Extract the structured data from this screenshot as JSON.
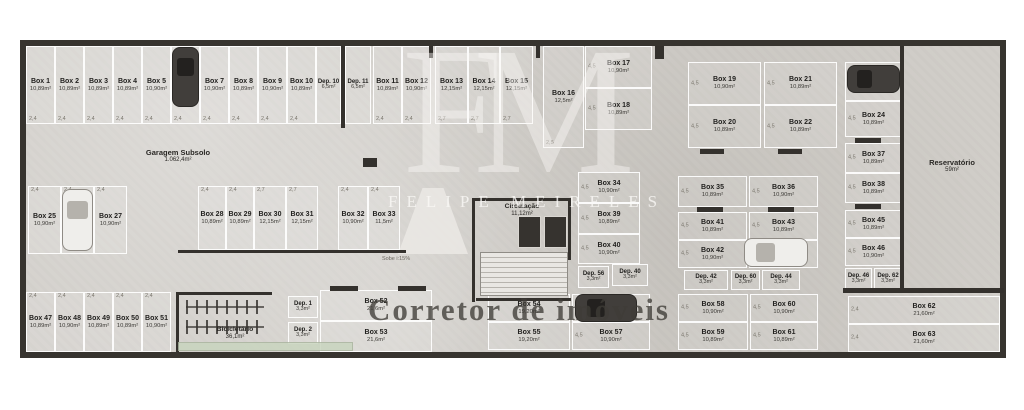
{
  "watermark": {
    "monogram": "FM",
    "name": "FELIPE MEIRELES",
    "tagline": "Corretor de imóveis"
  },
  "rooms": {
    "garage": {
      "label": "Garagem Subsolo",
      "area": "1.062,4m²"
    },
    "circulation": {
      "label": "Circulação",
      "area": "11,12m²"
    },
    "reservoir": {
      "label": "Reservatório",
      "area": "59m²"
    },
    "bike_room": {
      "label": "Bicicletário",
      "area": "36,1m²"
    }
  },
  "annotations": {
    "ramp": "Sobe i:15%"
  },
  "plan": {
    "boxes": [
      {
        "label": "Box 1",
        "area": "10,89m²",
        "x": 26,
        "y": 46,
        "w": 29,
        "h": 78,
        "t": "v",
        "dim": "2,4",
        "dp": "b"
      },
      {
        "label": "Box 2",
        "area": "10,89m²",
        "x": 55,
        "y": 46,
        "w": 29,
        "h": 78,
        "t": "v",
        "dim": "2,4",
        "dp": "b"
      },
      {
        "label": "Box 3",
        "area": "10,89m²",
        "x": 84,
        "y": 46,
        "w": 29,
        "h": 78,
        "t": "v",
        "dim": "2,4",
        "dp": "b"
      },
      {
        "label": "Box 4",
        "area": "10,89m²",
        "x": 113,
        "y": 46,
        "w": 29,
        "h": 78,
        "t": "v",
        "dim": "2,4",
        "dp": "b"
      },
      {
        "label": "Box 5",
        "area": "10,90m²",
        "x": 142,
        "y": 46,
        "w": 29,
        "h": 78,
        "t": "v",
        "dim": "2,4",
        "dp": "b"
      },
      {
        "label": "Box 6",
        "area": "10,89m²",
        "x": 171,
        "y": 46,
        "w": 29,
        "h": 78,
        "t": "v",
        "dim": "2,4",
        "dp": "b"
      },
      {
        "label": "Box 7",
        "area": "10,90m²",
        "x": 200,
        "y": 46,
        "w": 29,
        "h": 78,
        "t": "v",
        "dim": "2,4",
        "dp": "b"
      },
      {
        "label": "Box 8",
        "area": "10,89m²",
        "x": 229,
        "y": 46,
        "w": 29,
        "h": 78,
        "t": "v",
        "dim": "2,4",
        "dp": "b"
      },
      {
        "label": "Box 9",
        "area": "10,90m²",
        "x": 258,
        "y": 46,
        "w": 29,
        "h": 78,
        "t": "v",
        "dim": "2,4",
        "dp": "b"
      },
      {
        "label": "Box 10",
        "area": "10,89m²",
        "x": 287,
        "y": 46,
        "w": 29,
        "h": 78,
        "t": "v",
        "dim": "2,4",
        "dp": "b"
      },
      {
        "label": "Dep. 10",
        "area": "6,5m²",
        "x": 316,
        "y": 46,
        "w": 25,
        "h": 78,
        "t": "v",
        "dep": true
      },
      {
        "label": "Dep. 11",
        "area": "6,5m²",
        "x": 345,
        "y": 46,
        "w": 26,
        "h": 78,
        "t": "v",
        "dep": true
      },
      {
        "label": "Box 11",
        "area": "10,89m²",
        "x": 373,
        "y": 46,
        "w": 29,
        "h": 78,
        "t": "v",
        "dim": "2,4",
        "dp": "b"
      },
      {
        "label": "Box 12",
        "area": "10,90m²",
        "x": 402,
        "y": 46,
        "w": 29,
        "h": 78,
        "t": "v",
        "dim": "2,4",
        "dp": "b"
      },
      {
        "label": "Box 13",
        "area": "12,15m²",
        "x": 435,
        "y": 46,
        "w": 33,
        "h": 78,
        "t": "v",
        "dim": "2,7",
        "dp": "b"
      },
      {
        "label": "Box 14",
        "area": "12,15m²",
        "x": 468,
        "y": 46,
        "w": 32,
        "h": 78,
        "t": "v",
        "dim": "2,7",
        "dp": "b"
      },
      {
        "label": "Box 15",
        "area": "12,15m²",
        "x": 500,
        "y": 46,
        "w": 33,
        "h": 78,
        "t": "v",
        "dim": "2,7",
        "dp": "b"
      },
      {
        "label": "Box 16",
        "area": "12,5m²",
        "x": 543,
        "y": 46,
        "w": 41,
        "h": 102,
        "t": "v",
        "dim": "2,5",
        "dp": "b"
      },
      {
        "label": "Box 17",
        "area": "10,90m²",
        "x": 585,
        "y": 46,
        "w": 67,
        "h": 42,
        "t": "h",
        "dim": "4,5"
      },
      {
        "label": "Box 18",
        "area": "10,89m²",
        "x": 585,
        "y": 88,
        "w": 67,
        "h": 42,
        "t": "h",
        "dim": "4,5"
      },
      {
        "label": "Box 19",
        "area": "10,90m²",
        "x": 688,
        "y": 62,
        "w": 73,
        "h": 43,
        "t": "h",
        "dim": "4,5"
      },
      {
        "label": "Box 20",
        "area": "10,89m²",
        "x": 688,
        "y": 105,
        "w": 73,
        "h": 43,
        "t": "h",
        "dim": "4,5"
      },
      {
        "label": "Box 21",
        "area": "10,89m²",
        "x": 764,
        "y": 62,
        "w": 73,
        "h": 43,
        "t": "h",
        "dim": "4,5"
      },
      {
        "label": "Box 22",
        "area": "10,89m²",
        "x": 764,
        "y": 105,
        "w": 73,
        "h": 43,
        "t": "h",
        "dim": "4,5"
      },
      {
        "label": "Box 23",
        "area": "10,89m²",
        "x": 845,
        "y": 62,
        "w": 57,
        "h": 39,
        "t": "h"
      },
      {
        "label": "Box 24",
        "area": "10,89m²",
        "x": 845,
        "y": 101,
        "w": 57,
        "h": 36,
        "t": "h",
        "dim": "4,5"
      },
      {
        "label": "Box 25",
        "area": "10,90m²",
        "x": 28,
        "y": 186,
        "w": 33,
        "h": 68,
        "t": "v",
        "dim": "2,4",
        "dp": "t"
      },
      {
        "label": "Box 26",
        "area": "10,90m²",
        "x": 61,
        "y": 186,
        "w": 33,
        "h": 68,
        "t": "v",
        "dim": "2,4",
        "dp": "t"
      },
      {
        "label": "Box 27",
        "area": "10,90m²",
        "x": 94,
        "y": 186,
        "w": 33,
        "h": 68,
        "t": "v",
        "dim": "2,4",
        "dp": "t"
      },
      {
        "label": "Box 28",
        "area": "10,89m²",
        "x": 198,
        "y": 186,
        "w": 28,
        "h": 64,
        "t": "v",
        "dim": "2,4",
        "dp": "t"
      },
      {
        "label": "Box 29",
        "area": "10,89m²",
        "x": 226,
        "y": 186,
        "w": 28,
        "h": 64,
        "t": "v",
        "dim": "2,4",
        "dp": "t"
      },
      {
        "label": "Box 30",
        "area": "12,15m²",
        "x": 254,
        "y": 186,
        "w": 32,
        "h": 64,
        "t": "v",
        "dim": "2,7",
        "dp": "t"
      },
      {
        "label": "Box 31",
        "area": "12,15m²",
        "x": 286,
        "y": 186,
        "w": 32,
        "h": 64,
        "t": "v",
        "dim": "2,7",
        "dp": "t"
      },
      {
        "label": "Box 32",
        "area": "10,90m²",
        "x": 338,
        "y": 186,
        "w": 30,
        "h": 64,
        "t": "v",
        "dim": "2,4",
        "dp": "t"
      },
      {
        "label": "Box 33",
        "area": "11,5m²",
        "x": 368,
        "y": 186,
        "w": 32,
        "h": 64,
        "t": "v",
        "dim": "2,4",
        "dp": "t"
      },
      {
        "label": "Box 34",
        "area": "10,90m²",
        "x": 578,
        "y": 172,
        "w": 62,
        "h": 31,
        "t": "h",
        "dim": "4,5"
      },
      {
        "label": "Box 35",
        "area": "10,89m²",
        "x": 678,
        "y": 176,
        "w": 69,
        "h": 31,
        "t": "h",
        "dim": "4,5"
      },
      {
        "label": "Box 36",
        "area": "10,90m²",
        "x": 749,
        "y": 176,
        "w": 69,
        "h": 31,
        "t": "h",
        "dim": "4,5"
      },
      {
        "label": "Box 37",
        "area": "10,89m²",
        "x": 845,
        "y": 143,
        "w": 57,
        "h": 30,
        "t": "h",
        "dim": "4,5"
      },
      {
        "label": "Box 38",
        "area": "10,89m²",
        "x": 845,
        "y": 173,
        "w": 57,
        "h": 30,
        "t": "h",
        "dim": "4,5"
      },
      {
        "label": "Box 39",
        "area": "10,89m²",
        "x": 578,
        "y": 203,
        "w": 62,
        "h": 31,
        "t": "h",
        "dim": "4,5"
      },
      {
        "label": "Box 40",
        "area": "10,90m²",
        "x": 578,
        "y": 234,
        "w": 62,
        "h": 30,
        "t": "h",
        "dim": "4,5"
      },
      {
        "label": "Box 41",
        "area": "10,89m²",
        "x": 678,
        "y": 212,
        "w": 69,
        "h": 28,
        "t": "h",
        "dim": "4,5"
      },
      {
        "label": "Box 42",
        "area": "10,90m²",
        "x": 678,
        "y": 240,
        "w": 69,
        "h": 28,
        "t": "h",
        "dim": "4,5"
      },
      {
        "label": "Box 43",
        "area": "10,89m²",
        "x": 749,
        "y": 212,
        "w": 69,
        "h": 28,
        "t": "h",
        "dim": "4,5"
      },
      {
        "label": "Box 44",
        "area": "10,90m²",
        "x": 749,
        "y": 240,
        "w": 69,
        "h": 28,
        "t": "h"
      },
      {
        "label": "Box 45",
        "area": "10,89m²",
        "x": 845,
        "y": 210,
        "w": 57,
        "h": 28,
        "t": "h",
        "dim": "4,5"
      },
      {
        "label": "Box 46",
        "area": "10,90m²",
        "x": 845,
        "y": 238,
        "w": 57,
        "h": 28,
        "t": "h",
        "dim": "4,5"
      },
      {
        "label": "Box 47",
        "area": "10,89m²",
        "x": 26,
        "y": 292,
        "w": 29,
        "h": 60,
        "t": "v",
        "dim": "2,4",
        "dp": "t"
      },
      {
        "label": "Box 48",
        "area": "10,90m²",
        "x": 55,
        "y": 292,
        "w": 29,
        "h": 60,
        "t": "v",
        "dim": "2,4",
        "dp": "t"
      },
      {
        "label": "Box 49",
        "area": "10,89m²",
        "x": 84,
        "y": 292,
        "w": 29,
        "h": 60,
        "t": "v",
        "dim": "2,4",
        "dp": "t"
      },
      {
        "label": "Box 50",
        "area": "10,89m²",
        "x": 113,
        "y": 292,
        "w": 29,
        "h": 60,
        "t": "v",
        "dim": "2,4",
        "dp": "t"
      },
      {
        "label": "Box 51",
        "area": "10,90m²",
        "x": 142,
        "y": 292,
        "w": 29,
        "h": 60,
        "t": "v",
        "dim": "2,4",
        "dp": "t"
      },
      {
        "label": "Dep. 1",
        "area": "3,3m²",
        "x": 288,
        "y": 296,
        "w": 30,
        "h": 22,
        "t": "h",
        "dep": true
      },
      {
        "label": "Dep. 2",
        "area": "3,3m²",
        "x": 288,
        "y": 322,
        "w": 30,
        "h": 22,
        "t": "h",
        "dep": true
      },
      {
        "label": "Box 52",
        "area": "21,6m²",
        "x": 320,
        "y": 290,
        "w": 112,
        "h": 31,
        "t": "h"
      },
      {
        "label": "Box 53",
        "area": "21,6m²",
        "x": 320,
        "y": 321,
        "w": 112,
        "h": 31,
        "t": "h"
      },
      {
        "label": "Box 54",
        "area": "19,20m²",
        "x": 488,
        "y": 294,
        "w": 82,
        "h": 28,
        "t": "h"
      },
      {
        "label": "Box 55",
        "area": "19,20m²",
        "x": 488,
        "y": 322,
        "w": 82,
        "h": 28,
        "t": "h"
      },
      {
        "label": "Box 56",
        "area": "",
        "x": 572,
        "y": 294,
        "w": 78,
        "h": 28,
        "t": "h"
      },
      {
        "label": "Box 57",
        "area": "10,90m²",
        "x": 572,
        "y": 322,
        "w": 78,
        "h": 28,
        "t": "h",
        "dim": "4,5"
      },
      {
        "label": "Dep. 56",
        "area": "3,3m²",
        "x": 578,
        "y": 266,
        "w": 31,
        "h": 22,
        "t": "h",
        "dep": true
      },
      {
        "label": "Dep. 40",
        "area": "3,3m²",
        "x": 612,
        "y": 264,
        "w": 36,
        "h": 22,
        "t": "h",
        "dep": true
      },
      {
        "label": "Dep. 42",
        "area": "3,3m²",
        "x": 684,
        "y": 270,
        "w": 44,
        "h": 20,
        "t": "h",
        "dep": true
      },
      {
        "label": "Dep. 60",
        "area": "3,3m²",
        "x": 731,
        "y": 270,
        "w": 29,
        "h": 20,
        "t": "h",
        "dep": true
      },
      {
        "label": "Dep. 44",
        "area": "3,3m²",
        "x": 762,
        "y": 270,
        "w": 38,
        "h": 20,
        "t": "h",
        "dep": true
      },
      {
        "label": "Box 58",
        "area": "10,90m²",
        "x": 678,
        "y": 294,
        "w": 70,
        "h": 28,
        "t": "h",
        "dim": "4,5"
      },
      {
        "label": "Box 59",
        "area": "10,89m²",
        "x": 678,
        "y": 322,
        "w": 70,
        "h": 28,
        "t": "h",
        "dim": "4,5"
      },
      {
        "label": "Box 60",
        "area": "10,90m²",
        "x": 750,
        "y": 294,
        "w": 68,
        "h": 28,
        "t": "h",
        "dim": "4,5"
      },
      {
        "label": "Box 61",
        "area": "10,89m²",
        "x": 750,
        "y": 322,
        "w": 68,
        "h": 28,
        "t": "h",
        "dim": "4,5"
      },
      {
        "label": "Dep. 46",
        "area": "3,3m²",
        "x": 845,
        "y": 268,
        "w": 27,
        "h": 22,
        "t": "h",
        "dep": true
      },
      {
        "label": "Dep. 62",
        "area": "3,3m²",
        "x": 874,
        "y": 268,
        "w": 28,
        "h": 22,
        "t": "h",
        "dep": true
      },
      {
        "label": "Box 62",
        "area": "21,60m²",
        "x": 848,
        "y": 296,
        "w": 152,
        "h": 28,
        "t": "h",
        "dim": "2,4"
      },
      {
        "label": "Box 63",
        "area": "21,60m²",
        "x": 848,
        "y": 324,
        "w": 152,
        "h": 28,
        "t": "h",
        "dim": "2,4"
      }
    ],
    "cars": [
      {
        "x": 173,
        "y": 48,
        "w": 25,
        "h": 58,
        "dir": "v",
        "shade": "dark"
      },
      {
        "x": 848,
        "y": 66,
        "w": 51,
        "h": 26,
        "dir": "h",
        "shade": "dark"
      },
      {
        "x": 63,
        "y": 190,
        "w": 29,
        "h": 60,
        "dir": "v",
        "shade": "light"
      },
      {
        "x": 745,
        "y": 239,
        "w": 62,
        "h": 27,
        "dir": "h",
        "shade": "light"
      },
      {
        "x": 576,
        "y": 295,
        "w": 60,
        "h": 26,
        "dir": "h",
        "shade": "dark"
      }
    ]
  }
}
